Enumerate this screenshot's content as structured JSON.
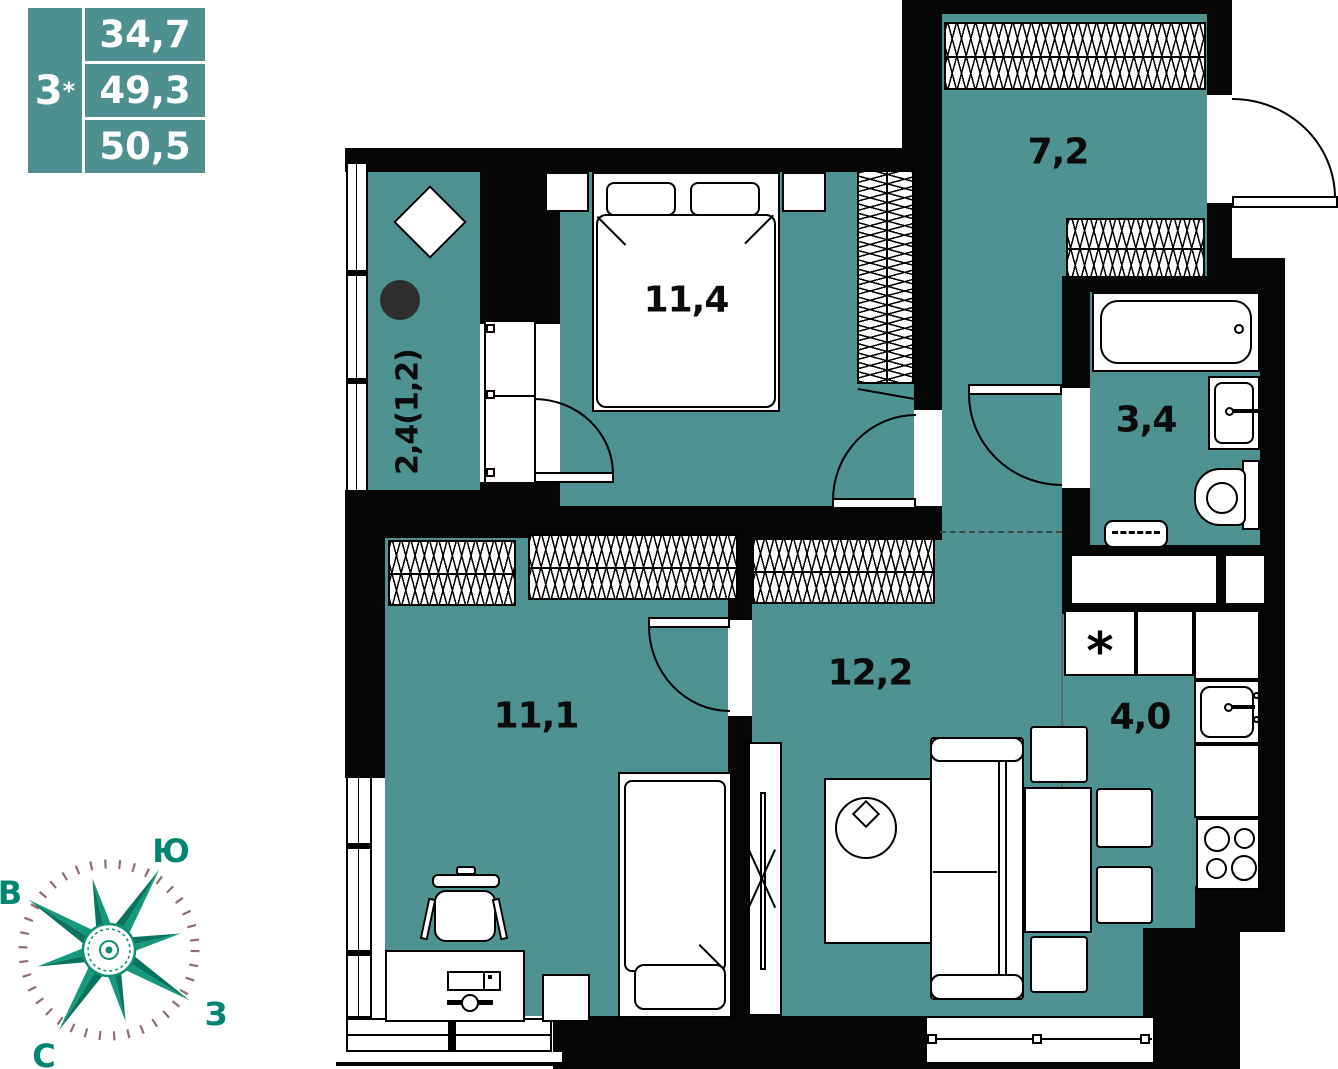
{
  "info_table": {
    "rooms_count": "3",
    "rooms_star": "*",
    "areas": [
      "34,7",
      "49,3",
      "50,5"
    ]
  },
  "rooms": {
    "balcony": "2,4(1,2)",
    "bedroom_main": "11,4",
    "hallway": "7,2",
    "bathroom": "3,4",
    "living": "12,2",
    "bedroom_second": "11,1",
    "kitchen": "4,0"
  },
  "compass": {
    "south": "Ю",
    "east": "В",
    "west": "З",
    "north": "С"
  },
  "fixtures": {
    "fridge_mark": "*"
  },
  "colors": {
    "room_fill": "#4f9292",
    "table_fill": "#4e8f8f",
    "wall": "#060606",
    "compass_green": "#0e9077",
    "compass_label": "#008670",
    "ticks": "#8f6e6e"
  }
}
